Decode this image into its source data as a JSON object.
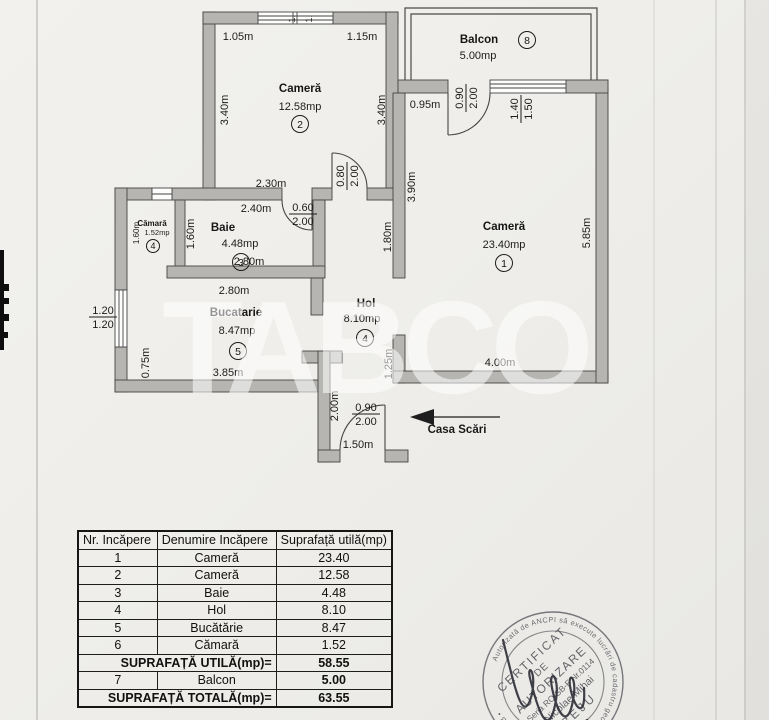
{
  "page": {
    "watermark": "TABCO"
  },
  "plan": {
    "casa_scari": "Casa Scări",
    "rooms": [
      {
        "name": "Cameră",
        "area": "12.58mp",
        "num": "2",
        "nx": 300,
        "ny": 92,
        "ax": 300,
        "ay": 110,
        "cx": 300,
        "cy": 124
      },
      {
        "name": "Balcon",
        "area": "5.00mp",
        "num": "8",
        "nx": 479,
        "ny": 43,
        "ax": 478,
        "ay": 59,
        "cx": 527,
        "cy": 40
      },
      {
        "name": "Cameră",
        "area": "23.40mp",
        "num": "1",
        "nx": 504,
        "ny": 230,
        "ax": 504,
        "ay": 248,
        "cx": 504,
        "cy": 263
      },
      {
        "name": "Baie",
        "area": "4.48mp",
        "num": "3",
        "nx": 223,
        "ny": 231,
        "ax": 240,
        "ay": 247,
        "cx": 241,
        "cy": 262
      },
      {
        "name": "Cămară",
        "area": "1.52mp",
        "num": "4",
        "small": true,
        "nx": 152,
        "ny": 226,
        "ax": 157,
        "ay": 235,
        "cx": 153,
        "cy": 246
      },
      {
        "name": "Bucatarie",
        "area": "8.47mp",
        "num": "5",
        "nx": 236,
        "ny": 316,
        "ax": 237,
        "ay": 334,
        "cx": 238,
        "cy": 351
      },
      {
        "name": "Hol",
        "area": "8.10mp",
        "num": "4",
        "nx": 366,
        "ny": 307,
        "ax": 362,
        "ay": 322,
        "cx": 365,
        "cy": 338
      }
    ],
    "dims": [
      {
        "t": "1.05m",
        "x": 238,
        "y": 36
      },
      {
        "t": "1.15m",
        "x": 362,
        "y": 36
      },
      {
        "t": "3.40m",
        "x": 224,
        "y": 110,
        "v": 1
      },
      {
        "t": "3.40m",
        "x": 381,
        "y": 110,
        "v": 1
      },
      {
        "t": "2.30m",
        "x": 271,
        "y": 183
      },
      {
        "t": "2.40m",
        "x": 256,
        "y": 208
      },
      {
        "a": "0.80",
        "b": "2.00",
        "x": 347,
        "y": 176,
        "v": 1
      },
      {
        "a": "0.60",
        "b": "2.00",
        "x": 303,
        "y": 214
      },
      {
        "t": "0.95m",
        "x": 425,
        "y": 104
      },
      {
        "a": "0.90",
        "b": "2.00",
        "x": 466,
        "y": 98,
        "v": 1
      },
      {
        "a": "1.40",
        "b": "1.50",
        "x": 521,
        "y": 109,
        "v": 1
      },
      {
        "t": "3.90m",
        "x": 411,
        "y": 187,
        "v": 1
      },
      {
        "t": "1.80m",
        "x": 387,
        "y": 237,
        "v": 1
      },
      {
        "t": "5.85m",
        "x": 586,
        "y": 233,
        "v": 1
      },
      {
        "t": "1.60m",
        "x": 190,
        "y": 234,
        "v": 1
      },
      {
        "t": "1.60m",
        "x": 135,
        "y": 233,
        "v": 1,
        "s": 8
      },
      {
        "t": "2.80m",
        "x": 249,
        "y": 261
      },
      {
        "t": "2.80m",
        "x": 234,
        "y": 290
      },
      {
        "a": "1.20",
        "b": "1.20",
        "x": 103,
        "y": 317
      },
      {
        "t": "0.75m",
        "x": 145,
        "y": 363,
        "v": 1
      },
      {
        "t": "3.85m",
        "x": 228,
        "y": 372
      },
      {
        "t": "1.25m",
        "x": 388,
        "y": 364,
        "v": 1
      },
      {
        "t": "2.00m",
        "x": 334,
        "y": 406,
        "v": 1
      },
      {
        "t": "1.50m",
        "x": 358,
        "y": 444
      },
      {
        "a": "0.90",
        "b": "2.00",
        "x": 366,
        "y": 414
      },
      {
        "t": "4.00m",
        "x": 500,
        "y": 362
      },
      {
        "t": "1.",
        "x": 291,
        "y": 15,
        "v": 1,
        "s": 9
      },
      {
        "t": "1.",
        "x": 308,
        "y": 15,
        "v": 1,
        "s": 9
      }
    ]
  },
  "table": {
    "headers": [
      "Nr. Incăpere",
      "Denumire Incăpere",
      "Suprafață utilă(mp)"
    ],
    "rows": [
      {
        "nr": "1",
        "name": "Cameră",
        "area": "23.40"
      },
      {
        "nr": "2",
        "name": "Cameră",
        "area": "12.58"
      },
      {
        "nr": "3",
        "name": "Baie",
        "area": "4.48"
      },
      {
        "nr": "4",
        "name": "Hol",
        "area": "8.10"
      },
      {
        "nr": "5",
        "name": "Bucătărie",
        "area": "8.47"
      },
      {
        "nr": "6",
        "name": "Cămară",
        "area": "1.52"
      },
      {
        "label": "SUPRAFAȚĂ UTILĂ(mp)=",
        "area": "58.55",
        "bold": true
      },
      {
        "nr": "7",
        "name": "Balcon",
        "area": "5.00",
        "boldArea": true
      },
      {
        "label": "SUPRAFAȚĂ TOTALĂ(mp)=",
        "area": "63.55",
        "bold": true
      }
    ]
  },
  "stamp": {
    "ring": "Autorizată de ANCPI să execute lucrări de cadastru geodezie și cartografie • SERIA B •",
    "line1": "CERTIFICAT",
    "line2": "DE",
    "line3": "AUTORIZARE",
    "line4": "Seria RO-SB-F Nr.0114",
    "line5": "Nicolae Mihai",
    "line6": "BEJU"
  }
}
